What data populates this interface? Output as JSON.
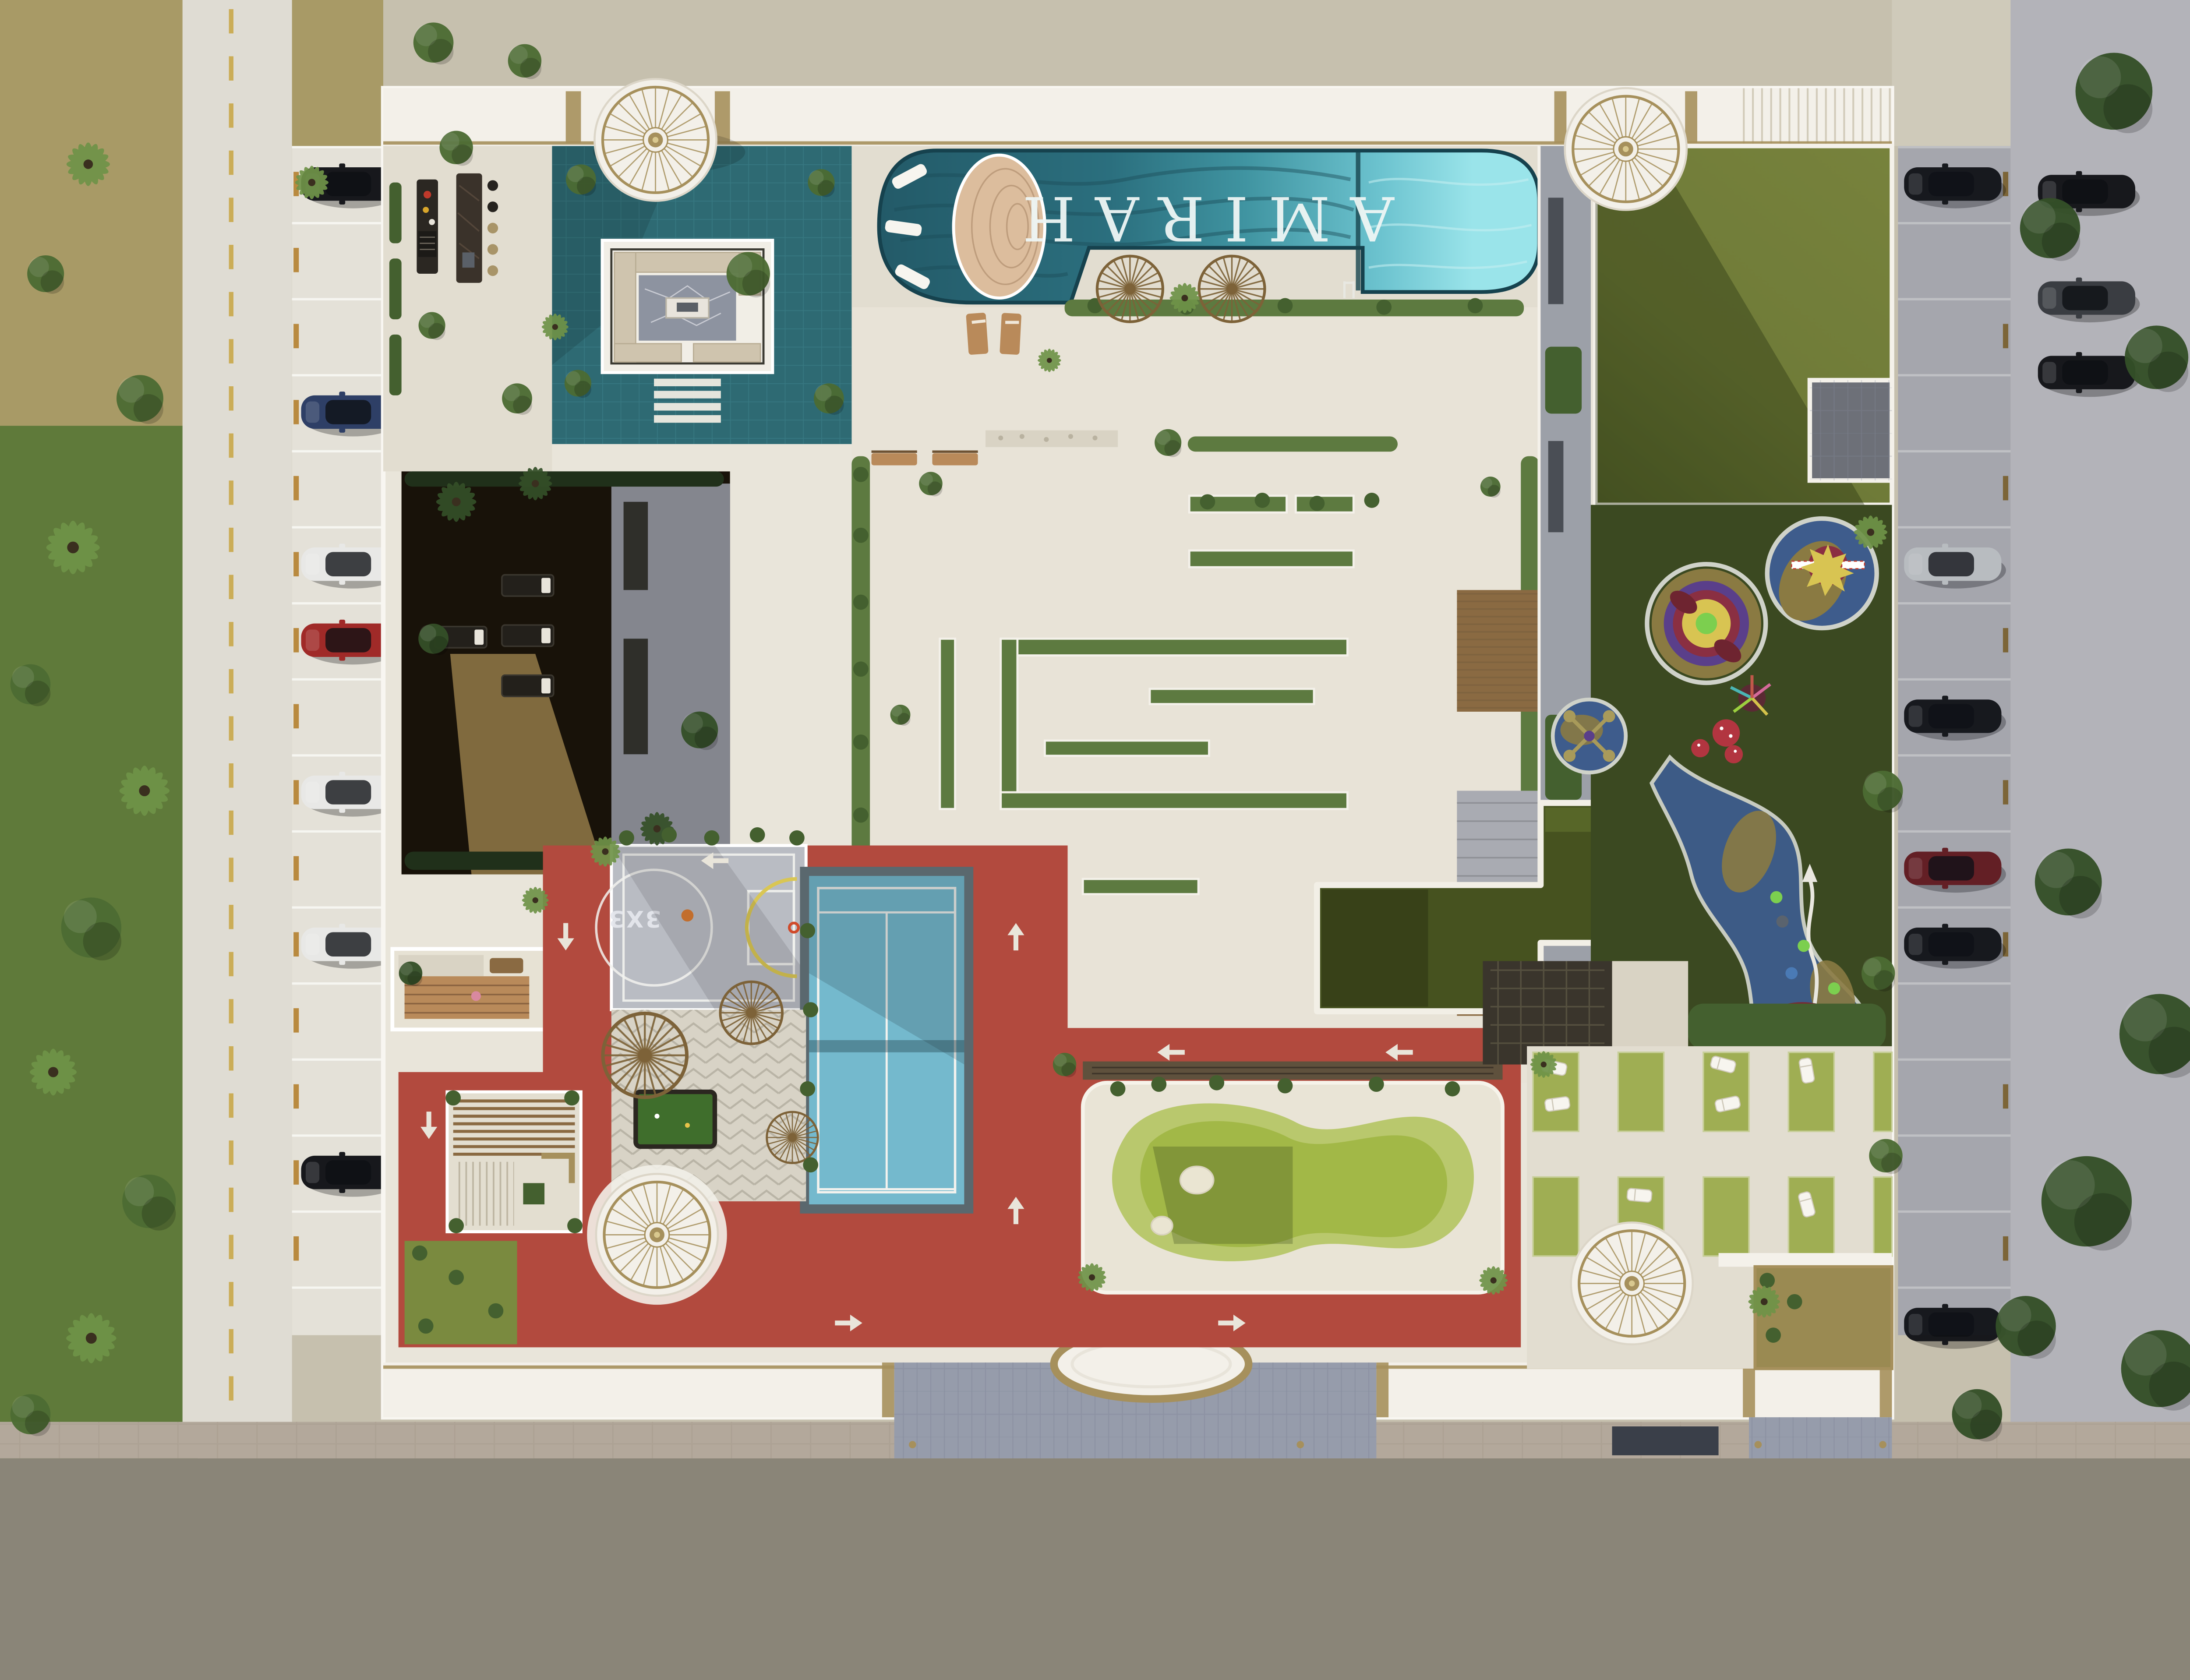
{
  "scene": {
    "type": "aerial-architectural-render",
    "description": "Top-down render of the AMIRAH residential amenity podium with pools, sport courts, jogging track, playground, gardens and street parking",
    "pool": {
      "label": "AMIRAH"
    },
    "sport_court": {
      "label": "3X3"
    },
    "areas": [
      "lap-pool",
      "pool-sun-shelf-deck",
      "in-pool-loungers",
      "jacuzzi-sunken-lounge",
      "teal-leisure-deck",
      "bbq-bar-counter",
      "dome-gazebo",
      "central-courtyard-planter-maze",
      "shaded-lounge-garden",
      "timber-deck-garden",
      "jogging-track",
      "basketball-3x3-court",
      "padel-tennis-court",
      "fan-shade-pergolas",
      "billiards-table",
      "timber-pergola-garden",
      "putting-green",
      "sunken-lawn-court",
      "great-lawn",
      "kids-playground",
      "lounger-terrace",
      "entrance-plaza",
      "entrance-canopy",
      "street-parking-left",
      "street-parking-right",
      "street-trees"
    ],
    "parking": {
      "left_cars": [
        {
          "slot": 1,
          "color_key": "car_black"
        },
        {
          "slot": 4,
          "color_key": "car_navy"
        },
        {
          "slot": 6,
          "color_key": "car_white"
        },
        {
          "slot": 7,
          "color_key": "car_red"
        },
        {
          "slot": 9,
          "color_key": "car_white"
        },
        {
          "slot": 11,
          "color_key": "car_white"
        },
        {
          "slot": 14,
          "color_key": "car_black"
        }
      ],
      "right_cars": [
        {
          "slot": 1,
          "color_key": "car_black"
        },
        {
          "slot": 6,
          "color_key": "car_silver"
        },
        {
          "slot": 8,
          "color_key": "car_black"
        },
        {
          "slot": 10,
          "color_key": "car_darkred"
        },
        {
          "slot": 11,
          "color_key": "car_black"
        },
        {
          "slot": 16,
          "color_key": "car_black"
        }
      ],
      "street_right_cars": [
        "car_black",
        "car_charcoal",
        "car_black"
      ]
    }
  },
  "palette": {
    "roof_white": "#f3f0e9",
    "roof_shade": "#ded9cd",
    "gold": "#a6905c",
    "gold_dark": "#8a7443",
    "podium": "#e9e5da",
    "paving": "#e2ddd0",
    "white_path": "#f4f1ea",
    "line_white": "#f2f2ee",
    "teal": "#2e6a73",
    "teal_line": "#3e838c",
    "pool_dark": "#235a68",
    "pool_mid": "#3f93a0",
    "pool_light": "#7fd0db",
    "pool_pale": "#9ae4ea",
    "wave": "#1c4d59",
    "pool_text": "#eef6f5",
    "sand_deck": "#dcbd9d",
    "sand_line": "#b99878",
    "lounger": "#f7f5ef",
    "wood": "#b98a5a",
    "wood_dark": "#8a6a42",
    "wood_deep": "#5f513d",
    "fan": "#7d6238",
    "gravel": "#d9d3c4",
    "hedge": "#5d7a40",
    "hedge_dark": "#44602f",
    "tree": "#4c6b33",
    "tree_dark": "#344f28",
    "palm": "#6f9348",
    "lawn_sun": "#6f7b38",
    "lawn_shade": "#49521f",
    "grass_dark": "#3b4921",
    "track": "#b24a3e",
    "arrow": "#e9e5da",
    "court_gray": "#b9bcc3",
    "key_yellow": "#d9c654",
    "ball": "#d97b33",
    "tennis": "#74b9cd",
    "tennis_frame": "#5a686e",
    "green_court": "#46521f",
    "putt_fringe": "#b9c86d",
    "putt_green": "#a2b847",
    "sand": "#eae5d2",
    "play_blue": "#3e5c8c",
    "play_tan": "#8a7a42",
    "play_purple": "#5a3f8a",
    "play_crimson": "#8a2f42",
    "play_yellow": "#d8c452",
    "play_green": "#7ccf4f",
    "play_red": "#b23540",
    "chevron": "#d8d3c6",
    "stone": "#8d93a0",
    "sofa": "#cfc4ae",
    "dark_garden": "#181209",
    "dark_path": "#8a7243",
    "gray_roof": "#9ca0a8",
    "gray_terrace": "#84868e",
    "pergola_dark": "#3a352c",
    "road": "#dfdcd3",
    "road_dash": "#c9a94a",
    "stall": "#e4e1d8",
    "stall_shade": "#b9b9bf",
    "road_shade": "#b3b3b9",
    "bottom_road": "#b3a89b",
    "plaza": "#969cab",
    "plaza_dark": "#6e7484",
    "left_ground": "#a89a66",
    "left_grass": "#5f7a3a",
    "car_black": "#17181c",
    "car_navy": "#2e3f66",
    "car_white": "#e8e8e6",
    "car_red": "#a02a28",
    "car_charcoal": "#3a3d42",
    "car_silver": "#cfd2d4",
    "car_darkred": "#6e1f24"
  }
}
